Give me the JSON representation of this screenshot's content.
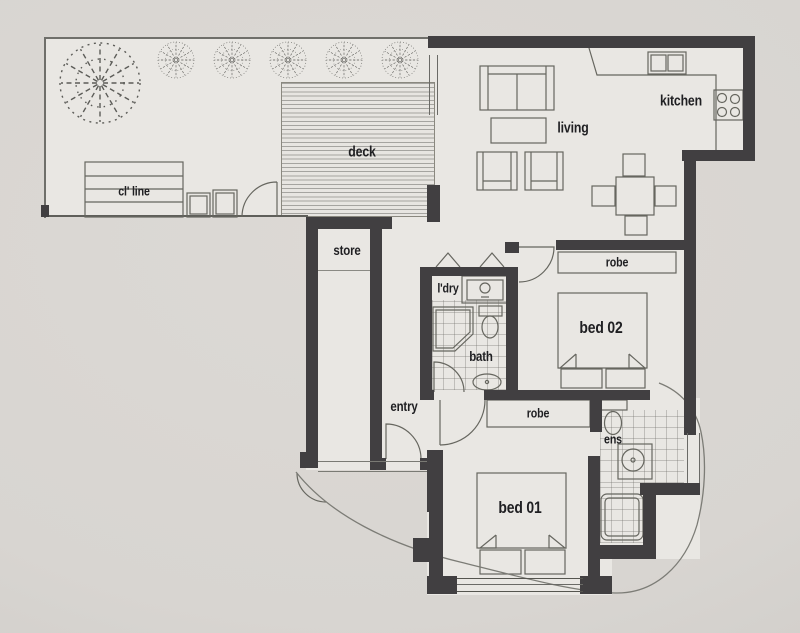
{
  "plan": {
    "type": "apartment floor plan",
    "labels": {
      "clothesline": "cl' line",
      "deck": "deck",
      "living": "living",
      "kitchen": "kitchen",
      "store": "store",
      "laundry": "l'dry",
      "bath": "bath",
      "robe_bed2": "robe",
      "bed2": "bed 02",
      "entry": "entry",
      "robe_bed1": "robe",
      "bed1": "bed 01",
      "ensuite": "ens"
    },
    "colors": {
      "paper": "#d8d5d1",
      "floor": "#e9e7e3",
      "wall": "#413f41",
      "line": "#66665f",
      "text": "#1f1f22"
    }
  }
}
